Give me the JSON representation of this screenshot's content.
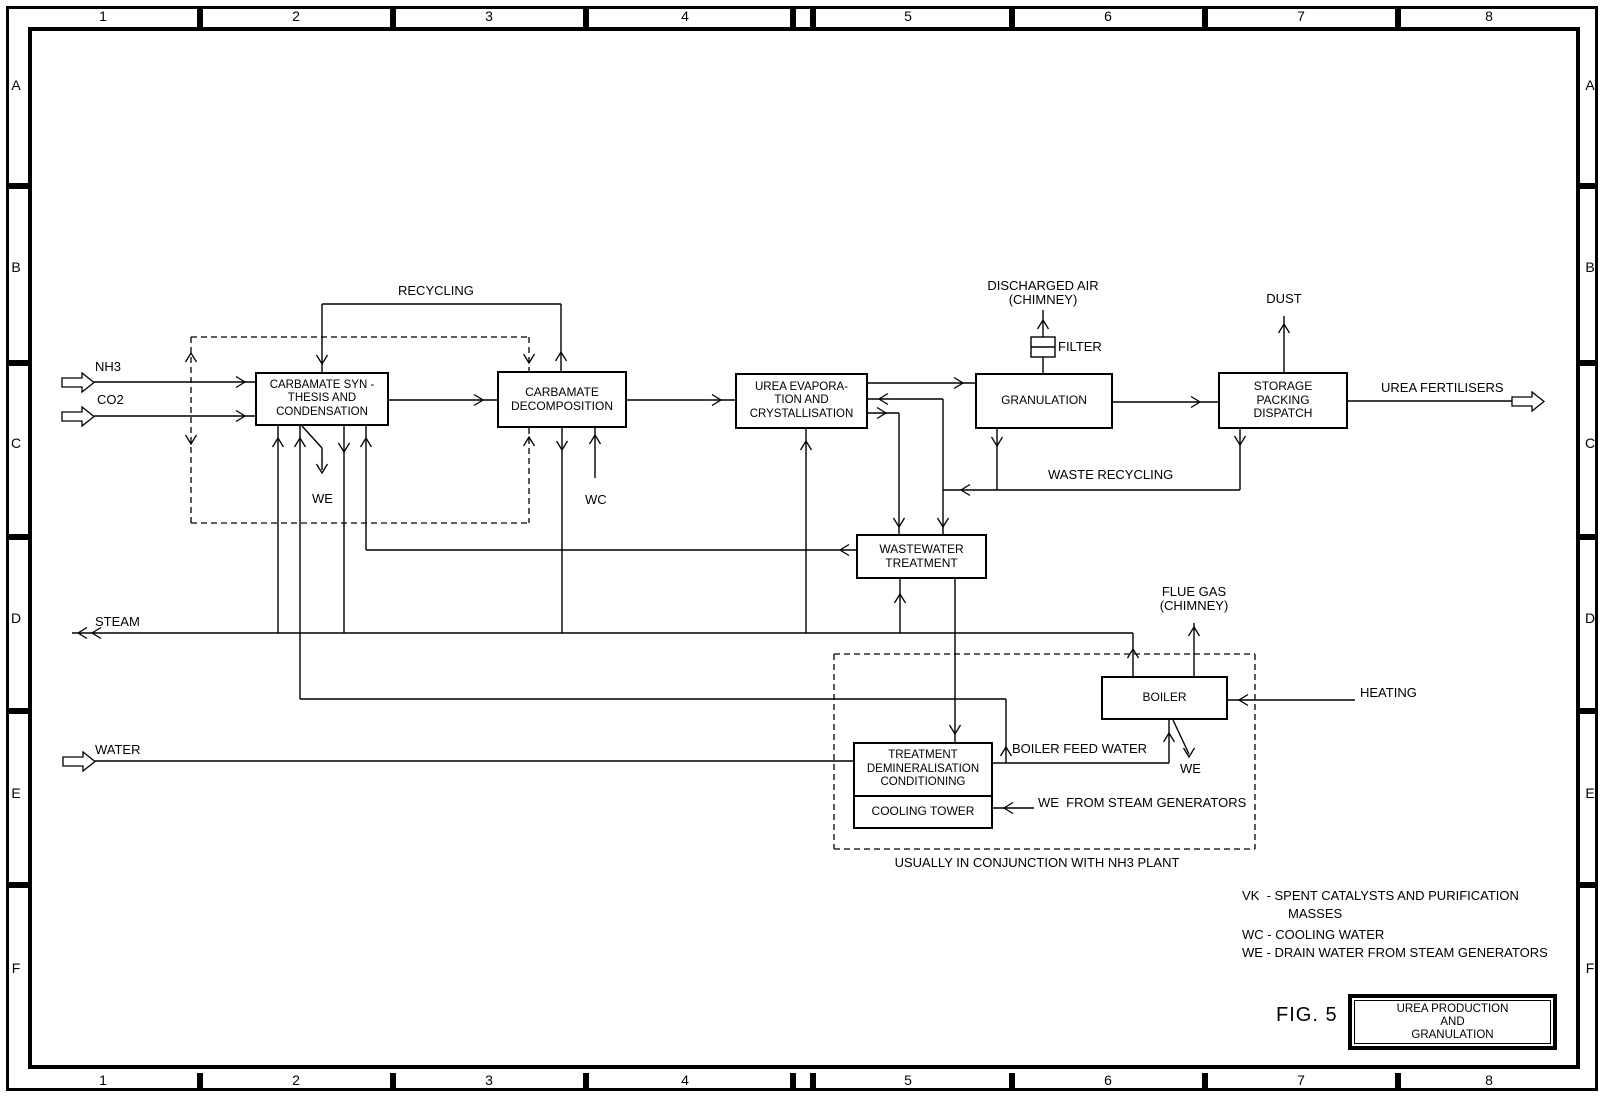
{
  "figure": {
    "fig_label": "FIG. 5",
    "title_block": "UREA PRODUCTION\nAND\nGRANULATION"
  },
  "grid": {
    "cols": [
      "1",
      "2",
      "3",
      "4",
      "5",
      "6",
      "7",
      "8"
    ],
    "rows": [
      "A",
      "B",
      "C",
      "D",
      "E",
      "F"
    ]
  },
  "boxes": {
    "carbamate_synthesis": "CARBAMATE SYN -\nTHESIS AND\nCONDENSATION",
    "carbamate_decomposition": "CARBAMATE\nDECOMPOSITION",
    "urea_evaporation": "UREA EVAPORA-\nTION AND\nCRYSTALLISATION",
    "granulation": "GRANULATION",
    "storage": "STORAGE\nPACKING\nDISPATCH",
    "wastewater_treatment": "WASTEWATER\nTREATMENT",
    "boiler": "BOILER",
    "water_treatment": "TREATMENT\nDEMINERALISATION\nCONDITIONING",
    "cooling_tower": "COOLING TOWER"
  },
  "labels": {
    "recycling": "RECYCLING",
    "nh3": "NH3",
    "co2": "CO2",
    "we_synthesis": "WE",
    "wc_decomposition": "WC",
    "discharged_air": "DISCHARGED AIR",
    "discharged_air_chimney": "(CHIMNEY)",
    "filter": "FILTER",
    "dust": "DUST",
    "urea_fertilisers": "UREA FERTILISERS",
    "waste_recycling": "WASTE RECYCLING",
    "steam": "STEAM",
    "flue_gas": "FLUE GAS",
    "flue_gas_chimney": "(CHIMNEY)",
    "heating": "HEATING",
    "water": "WATER",
    "boiler_feed_water": "BOILER FEED WATER",
    "we_boiler": "WE",
    "we_from_steam_generators": "WE  FROM STEAM GENERATORS",
    "conjunction_note": "USUALLY IN CONJUNCTION WITH NH3 PLANT"
  },
  "legend": {
    "rows": [
      "VK  - SPENT CATALYSTS AND PURIFICATION",
      "MASSES",
      "WC - COOLING WATER",
      "WE - DRAIN WATER FROM STEAM GENERATORS"
    ]
  }
}
